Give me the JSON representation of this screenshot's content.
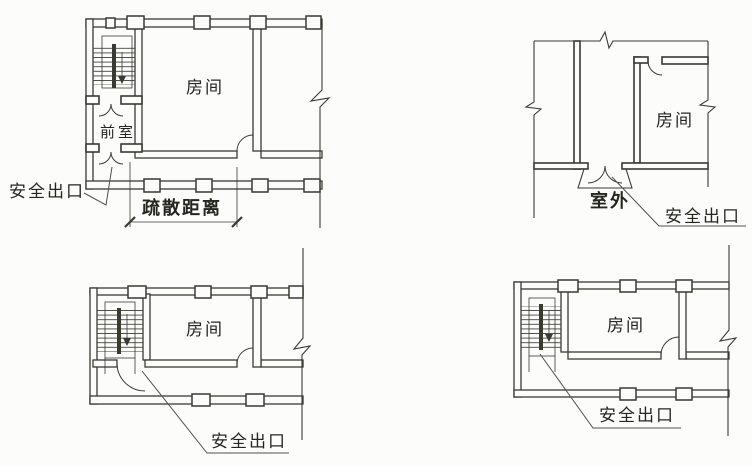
{
  "figure": {
    "background": "#fcfcfa",
    "ink": "#3a3a32",
    "text_ink": "#262620",
    "plans": {
      "top_left": {
        "room": "房间",
        "anteroom": "前室",
        "exit": "安全出口",
        "distance": "疏散距离"
      },
      "top_right": {
        "room": "房间",
        "outside": "室外",
        "exit": "安全出口"
      },
      "bottom_left": {
        "room": "房间",
        "exit": "安全出口"
      },
      "bottom_right": {
        "room": "房间",
        "exit": "安全出口"
      }
    }
  }
}
